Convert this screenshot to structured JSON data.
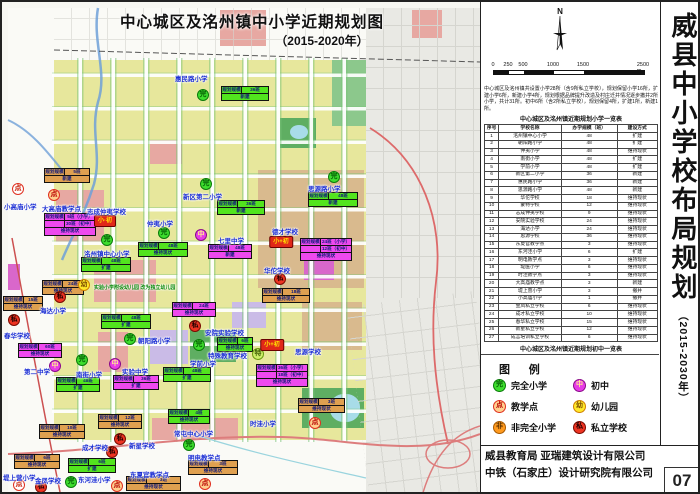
{
  "poster": {
    "map_title_line1": "中心城区及洺州镇中小学近期规划图",
    "map_title_line2": "（2015-2020年）",
    "side_title": "威县中小学校布局规划",
    "side_title_sub": "（2015-2030年）",
    "north_label": "N",
    "page_number": "07",
    "credits_line1": "威县教育局  亚瑞建筑设计有限公司",
    "credits_line2": "中铁（石家庄）设计研究院有限公司"
  },
  "scale_bar": {
    "labels": [
      {
        "text": "0",
        "x": 0
      },
      {
        "text": "250",
        "x": 15
      },
      {
        "text": "500",
        "x": 30
      },
      {
        "text": "1000",
        "x": 60
      },
      {
        "text": "1500",
        "x": 90
      },
      {
        "text": "2500 m",
        "x": 150
      }
    ]
  },
  "intro_text": "中心城区及洺州镇共设置小学28所（含9所私立学校），规划保留小学16所，扩建小学6所，新建小学4所，规划根据品牌提升改造及村庄迁并情况逐步撤并2所小学，共计31所。初中6所（含2所私立学校），规划保留4所，扩建1所，新建1所。",
  "tables": [
    {
      "title": "中心城区及洺州镇近期规划小学一览表",
      "headers": [
        "序号",
        "学校名称",
        "办学规模（班）",
        "建设方式"
      ],
      "col_widths": [
        14,
        62,
        55,
        40
      ],
      "rows": [
        [
          "1",
          "洺州镇中心小学",
          "48",
          "扩建"
        ],
        [
          "2",
          "朝阳路小学",
          "48",
          "扩建"
        ],
        [
          "3",
          "仲夷小学",
          "48",
          "维持现状"
        ],
        [
          "4",
          "南街小学",
          "48",
          "扩建"
        ],
        [
          "5",
          "学前小学",
          "48",
          "扩建"
        ],
        [
          "6",
          "新区第二小学",
          "36",
          "新建"
        ],
        [
          "7",
          "惠民路小学",
          "36",
          "新建"
        ],
        [
          "8",
          "思源路小学",
          "48",
          "新建"
        ],
        [
          "9",
          "华佗学校",
          "18",
          "维持现状"
        ],
        [
          "10",
          "蒙特学校",
          "12",
          "维持现状"
        ],
        [
          "11",
          "志成仲夷学校",
          "9",
          "维持现状"
        ],
        [
          "12",
          "安院实验学校",
          "24",
          "维持现状"
        ],
        [
          "13",
          "海达小学",
          "24",
          "维持现状"
        ],
        [
          "14",
          "思源学校",
          "36",
          "维持现状"
        ],
        [
          "15",
          "东夏官教学点",
          "3",
          "维持现状"
        ],
        [
          "16",
          "东河洼小学",
          "6",
          "扩建"
        ],
        [
          "17",
          "明电教学点",
          "3",
          "维持现状"
        ],
        [
          "18",
          "堤医小学",
          "6",
          "维持现状"
        ],
        [
          "19",
          "时洼教学点",
          "3",
          "维持现状"
        ],
        [
          "20",
          "大高庙教学点",
          "3",
          "新建"
        ],
        [
          "21",
          "堤上营小学",
          "3",
          "撤并"
        ],
        [
          "22",
          "小高庙小学",
          "1",
          "撤并"
        ],
        [
          "23",
          "金凤私立学校",
          "6",
          "维持现状"
        ],
        [
          "24",
          "成才私立学校",
          "10",
          "维持现状"
        ],
        [
          "25",
          "春华私立学校",
          "15",
          "维持现状"
        ],
        [
          "26",
          "新星私立学校",
          "12",
          "维持现状"
        ],
        [
          "27",
          "成言培训私立学校",
          "6",
          "维持现状"
        ]
      ]
    },
    {
      "title": "中心城区及洺州镇近期规划初中一览表",
      "headers": [
        "序号",
        "学校名称",
        "办学规模（班）",
        "建设方式"
      ],
      "col_widths": [
        14,
        62,
        55,
        40
      ],
      "rows": [
        [
          "1",
          "七里中学",
          "48",
          "新建"
        ],
        [
          "2",
          "第二中学",
          "60",
          "维持现状"
        ],
        [
          "3",
          "实验中学",
          "36",
          "扩建"
        ],
        [
          "4",
          "思源学校",
          "18",
          "维持现状"
        ],
        [
          "5",
          "德才学校",
          "12",
          "维持现状"
        ],
        [
          "6",
          "志成仲夷学校",
          "30",
          "维持现状"
        ]
      ]
    }
  ],
  "legend": {
    "title": "图  例",
    "items": [
      {
        "letter": "完",
        "label": "完全小学",
        "type": "wan",
        "col": 0,
        "row": 0
      },
      {
        "letter": "中",
        "label": "初中",
        "type": "zhong",
        "col": 1,
        "row": 0
      },
      {
        "letter": "点",
        "label": "教学点",
        "type": "dian",
        "col": 0,
        "row": 1
      },
      {
        "letter": "幼",
        "label": "幼儿园",
        "type": "you",
        "col": 1,
        "row": 1
      },
      {
        "letter": "非",
        "label": "非完全小学",
        "type": "fei",
        "col": 0,
        "row": 2
      },
      {
        "letter": "私",
        "label": "私立学校",
        "type": "si",
        "col": 1,
        "row": 2
      }
    ]
  },
  "map": {
    "markers": [
      {
        "name": "惠民路小学",
        "badge": "完",
        "type": "wan",
        "bx": 201,
        "by": 93,
        "nx": 173,
        "ny": 71,
        "box": {
          "x": 219,
          "y": 84,
          "w": 48,
          "c": "g",
          "rows": [
            [
              "规划规模",
              "36班"
            ],
            [
              "新建"
            ]
          ]
        }
      },
      {
        "name": "思源路小学",
        "badge": "完",
        "type": "wan",
        "bx": 332,
        "by": 175,
        "nx": 306,
        "ny": 181,
        "box": {
          "x": 306,
          "y": 190,
          "w": 50,
          "c": "g",
          "rows": [
            [
              "规划规模",
              "48班"
            ],
            [
              "新建"
            ]
          ]
        }
      },
      {
        "name": "新区第二小学",
        "badge": "完",
        "type": "wan",
        "bx": 204,
        "by": 182,
        "nx": 181,
        "ny": 189,
        "box": {
          "x": 215,
          "y": 198,
          "w": 48,
          "c": "g",
          "rows": [
            [
              "规划规模",
              "36班"
            ],
            [
              "新建"
            ]
          ]
        }
      },
      {
        "name": "小高庙小学",
        "badge": "点",
        "type": "dianw",
        "bx": 16,
        "by": 187,
        "nx": 2,
        "ny": 199
      },
      {
        "name": "大高庙教学点",
        "badge": "点",
        "type": "dian",
        "bx": 52,
        "by": 193,
        "nx": 40,
        "ny": 201,
        "box": {
          "x": 42,
          "y": 166,
          "w": 46,
          "c": "t",
          "rows": [
            [
              "规划规模",
              "5班"
            ],
            [
              "新建"
            ]
          ]
        }
      },
      {
        "name": "志成仲夷学校",
        "badge": "小·初",
        "type": "xc",
        "bx": 103,
        "by": 219,
        "nx": 85,
        "ny": 204,
        "box": {
          "x": 42,
          "y": 211,
          "w": 52,
          "c": "m",
          "rows": [
            [
              "规划规模",
              "5班（小学）"
            ],
            [
              "",
              "30班（初中）"
            ],
            [
              "维持现状"
            ]
          ]
        }
      },
      {
        "name": "仲夷小学",
        "badge": "完",
        "type": "wan",
        "bx": 162,
        "by": 231,
        "nx": 145,
        "ny": 216,
        "box": {
          "x": 136,
          "y": 240,
          "w": 50,
          "c": "g",
          "rows": [
            [
              "规划规模",
              "48班"
            ],
            [
              "维持现状"
            ]
          ]
        }
      },
      {
        "name": "七里中学",
        "badge": "中",
        "type": "zhong",
        "bx": 199,
        "by": 233,
        "nx": 216,
        "ny": 233,
        "box": {
          "x": 206,
          "y": 242,
          "w": 44,
          "c": "m",
          "rows": [
            [
              "规划规模",
              "48班"
            ],
            [
              "新建"
            ]
          ]
        }
      },
      {
        "name": "洺州镇中心小学",
        "badge": "完",
        "type": "wan",
        "bx": 105,
        "by": 238,
        "nx": 82,
        "ny": 246,
        "box": {
          "x": 79,
          "y": 255,
          "w": 50,
          "c": "g",
          "rows": [
            [
              "规划规模",
              "48班"
            ],
            [
              "扩建"
            ]
          ]
        }
      },
      {
        "name": "德才学校",
        "badge": "小+初",
        "type": "xc",
        "bx": 279,
        "by": 240,
        "nx": 270,
        "ny": 224,
        "box": {
          "x": 298,
          "y": 236,
          "w": 52,
          "c": "m",
          "rows": [
            [
              "规划规模",
              "24班（小学）"
            ],
            [
              "",
              "12班（初中）"
            ],
            [
              "维持现状"
            ]
          ]
        }
      },
      {
        "name": "华佗学校",
        "badge": "私",
        "type": "si",
        "bx": 278,
        "by": 277,
        "nx": 262,
        "ny": 263,
        "box": {
          "x": 260,
          "y": 286,
          "w": 48,
          "c": "t",
          "rows": [
            [
              "规划规模",
              "18班"
            ],
            [
              "维持现状"
            ]
          ]
        }
      },
      {
        "name": "海达小学",
        "badge": "私",
        "type": "si",
        "bx": 58,
        "by": 295,
        "nx": 38,
        "ny": 303,
        "box": {
          "x": 40,
          "y": 278,
          "w": 42,
          "c": "t",
          "rows": [
            [
              "规划规模",
              "24班"
            ],
            [
              "维持现状"
            ]
          ]
        }
      },
      {
        "name": "实验小学附设幼儿园 改为独立幼儿园",
        "badge": "幼",
        "type": "you",
        "bx": 82,
        "by": 283,
        "nx": 92,
        "ny": 282,
        "green": true
      },
      {
        "name": "春华学校",
        "badge": "私",
        "type": "si",
        "bx": 12,
        "by": 318,
        "nx": 2,
        "ny": 328,
        "box": {
          "x": 1,
          "y": 294,
          "w": 40,
          "c": "t",
          "rows": [
            [
              "规划规模",
              "15班"
            ],
            [
              "维持现状"
            ]
          ]
        }
      },
      {
        "name": "朝阳路小学",
        "badge": "完",
        "type": "wan",
        "bx": 128,
        "by": 337,
        "nx": 136,
        "ny": 333,
        "box": {
          "x": 99,
          "y": 312,
          "w": 50,
          "c": "g",
          "rows": [
            [
              "规划规模",
              "48班"
            ],
            [
              "扩建"
            ]
          ]
        }
      },
      {
        "name": "安院实验学校",
        "badge": "私",
        "type": "si",
        "bx": 193,
        "by": 324,
        "nx": 203,
        "ny": 325,
        "box": {
          "x": 170,
          "y": 300,
          "w": 44,
          "c": "m",
          "rows": [
            [
              "规划规模",
              "24班"
            ],
            [
              "维持现状"
            ]
          ]
        }
      },
      {
        "name": "特殊教育学校",
        "badge": "特",
        "type": "te",
        "bx": 256,
        "by": 352,
        "nx": 206,
        "ny": 348,
        "box": {
          "x": 215,
          "y": 335,
          "w": 36,
          "c": "g",
          "rows": [
            [
              "规划规模",
              "6班"
            ],
            [
              "维持现状"
            ]
          ]
        }
      },
      {
        "name": "思源学校",
        "badge": "小+初",
        "type": "xc",
        "bx": 270,
        "by": 343,
        "nx": 293,
        "ny": 344,
        "box": {
          "x": 254,
          "y": 362,
          "w": 52,
          "c": "m",
          "rows": [
            [
              "规划规模",
              "36班（小学）"
            ],
            [
              "",
              "18班（初中）"
            ],
            [
              "维持现状"
            ]
          ]
        }
      },
      {
        "name": "学前小学",
        "badge": "完",
        "type": "wan",
        "bx": 197,
        "by": 343,
        "nx": 188,
        "ny": 356,
        "box": {
          "x": 161,
          "y": 365,
          "w": 48,
          "c": "g",
          "rows": [
            [
              "规划规模",
              "48班"
            ],
            [
              "扩建"
            ]
          ]
        }
      },
      {
        "name": "第二中学",
        "badge": "中",
        "type": "zhong",
        "bx": 53,
        "by": 364,
        "nx": 22,
        "ny": 364,
        "box": {
          "x": 16,
          "y": 341,
          "w": 44,
          "c": "m",
          "rows": [
            [
              "规划规模",
              "60班"
            ],
            [
              "维持现状"
            ]
          ]
        }
      },
      {
        "name": "南街小学",
        "badge": "完",
        "type": "wan",
        "bx": 80,
        "by": 358,
        "nx": 74,
        "ny": 367,
        "box": {
          "x": 54,
          "y": 375,
          "w": 44,
          "c": "g",
          "rows": [
            [
              "规划规模",
              "48班"
            ],
            [
              "扩建"
            ]
          ]
        }
      },
      {
        "name": "实验中学",
        "badge": "中",
        "type": "zhong",
        "bx": 113,
        "by": 362,
        "nx": 120,
        "ny": 364,
        "box": {
          "x": 111,
          "y": 373,
          "w": 46,
          "c": "m",
          "rows": [
            [
              "规划规模",
              "36班"
            ],
            [
              "扩建"
            ]
          ]
        }
      },
      {
        "name": "常屯中心小学",
        "badge": "完",
        "type": "wan",
        "bx": 187,
        "by": 443,
        "nx": 172,
        "ny": 426,
        "box": {
          "x": 166,
          "y": 407,
          "w": 42,
          "c": "g",
          "rows": [
            [
              "规划规模",
              "4班"
            ],
            [
              "维持现状"
            ]
          ]
        }
      },
      {
        "name": "时洼小学",
        "badge": "点",
        "type": "dian",
        "bx": 313,
        "by": 421,
        "nx": 248,
        "ny": 416,
        "box": {
          "x": 296,
          "y": 396,
          "w": 47,
          "c": "t",
          "rows": [
            [
              "规划规模",
              "3班"
            ],
            [
              "维持现状"
            ]
          ]
        }
      },
      {
        "name": "明电教学点",
        "badge": "点",
        "type": "dian",
        "bx": 203,
        "by": 482,
        "nx": 186,
        "ny": 450,
        "box": {
          "x": 186,
          "y": 458,
          "w": 50,
          "c": "t",
          "rows": [
            [
              "规划规模",
              "3班"
            ],
            [
              "维持现状"
            ]
          ]
        }
      },
      {
        "name": "堤上营小学",
        "badge": "点",
        "type": "dianw",
        "bx": 17,
        "by": 483,
        "nx": 1,
        "ny": 470
      },
      {
        "name": "金凤学校",
        "badge": "私",
        "type": "si",
        "bx": 39,
        "by": 485,
        "nx": 33,
        "ny": 473,
        "box": {
          "x": 12,
          "y": 452,
          "w": 46,
          "c": "t",
          "rows": [
            [
              "规划规模",
              "6班"
            ],
            [
              "维持现状"
            ]
          ]
        }
      },
      {
        "name": "成才学校",
        "badge": "私",
        "type": "si",
        "bx": 110,
        "by": 450,
        "nx": 80,
        "ny": 440,
        "box": {
          "x": 37,
          "y": 422,
          "w": 46,
          "c": "t",
          "rows": [
            [
              "规划规模",
              "10班"
            ],
            [
              "维持现状"
            ]
          ]
        }
      },
      {
        "name": "新星学校",
        "badge": "私",
        "type": "si",
        "bx": 118,
        "by": 437,
        "nx": 127,
        "ny": 438,
        "box": {
          "x": 96,
          "y": 412,
          "w": 44,
          "c": "t",
          "rows": [
            [
              "规划规模",
              "12班"
            ],
            [
              "维持现状"
            ]
          ]
        }
      },
      {
        "name": "东河洼小学",
        "badge": "完",
        "type": "wan",
        "bx": 69,
        "by": 480,
        "nx": 76,
        "ny": 472,
        "box": {
          "x": 66,
          "y": 456,
          "w": 48,
          "c": "g",
          "rows": [
            [
              "规划规模",
              "6班"
            ],
            [
              "扩建"
            ]
          ]
        }
      },
      {
        "name": "东夏官教学点",
        "badge": "点",
        "type": "dian",
        "bx": 115,
        "by": 484,
        "nx": 128,
        "ny": 467,
        "box": {
          "x": 124,
          "y": 474,
          "w": 55,
          "c": "t",
          "rows": [
            [
              "规划规模",
              "3班"
            ],
            [
              "维持现状"
            ]
          ]
        }
      }
    ]
  }
}
